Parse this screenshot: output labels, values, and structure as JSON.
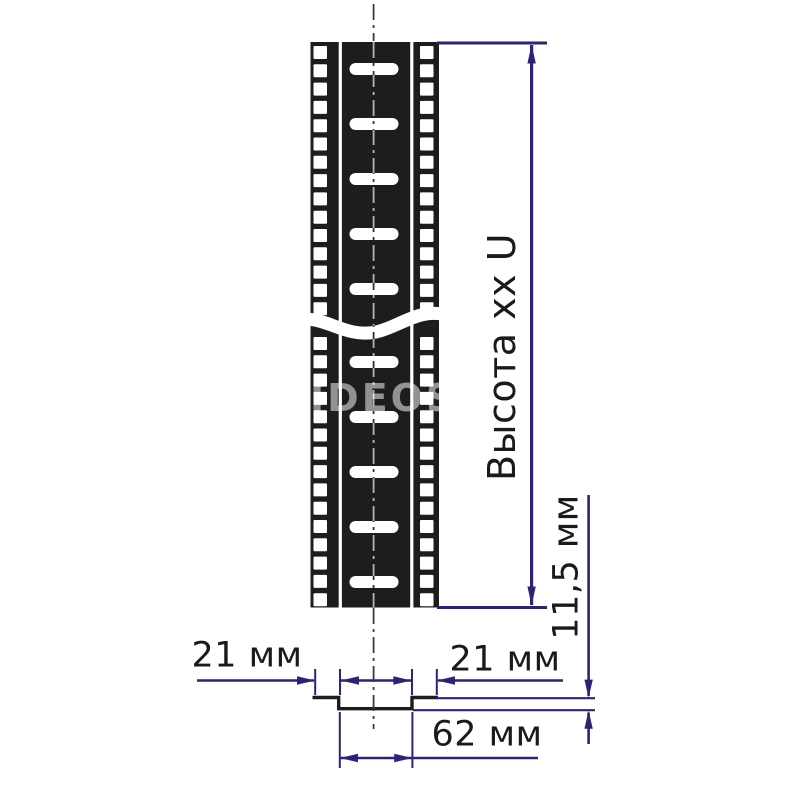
{
  "diagram": {
    "type": "technical-drawing",
    "subject": "rack-mounting-profile",
    "labels": {
      "height": "Высота xx U",
      "depth": "11,5 мм",
      "flange_left": "21 мм",
      "flange_right": "21 мм",
      "channel_width": "62 мм"
    },
    "watermark": "VIDEOS",
    "colors": {
      "ink": "#1d1d1b",
      "dimension": "#2d2376",
      "text": "#1a1a1a"
    }
  }
}
